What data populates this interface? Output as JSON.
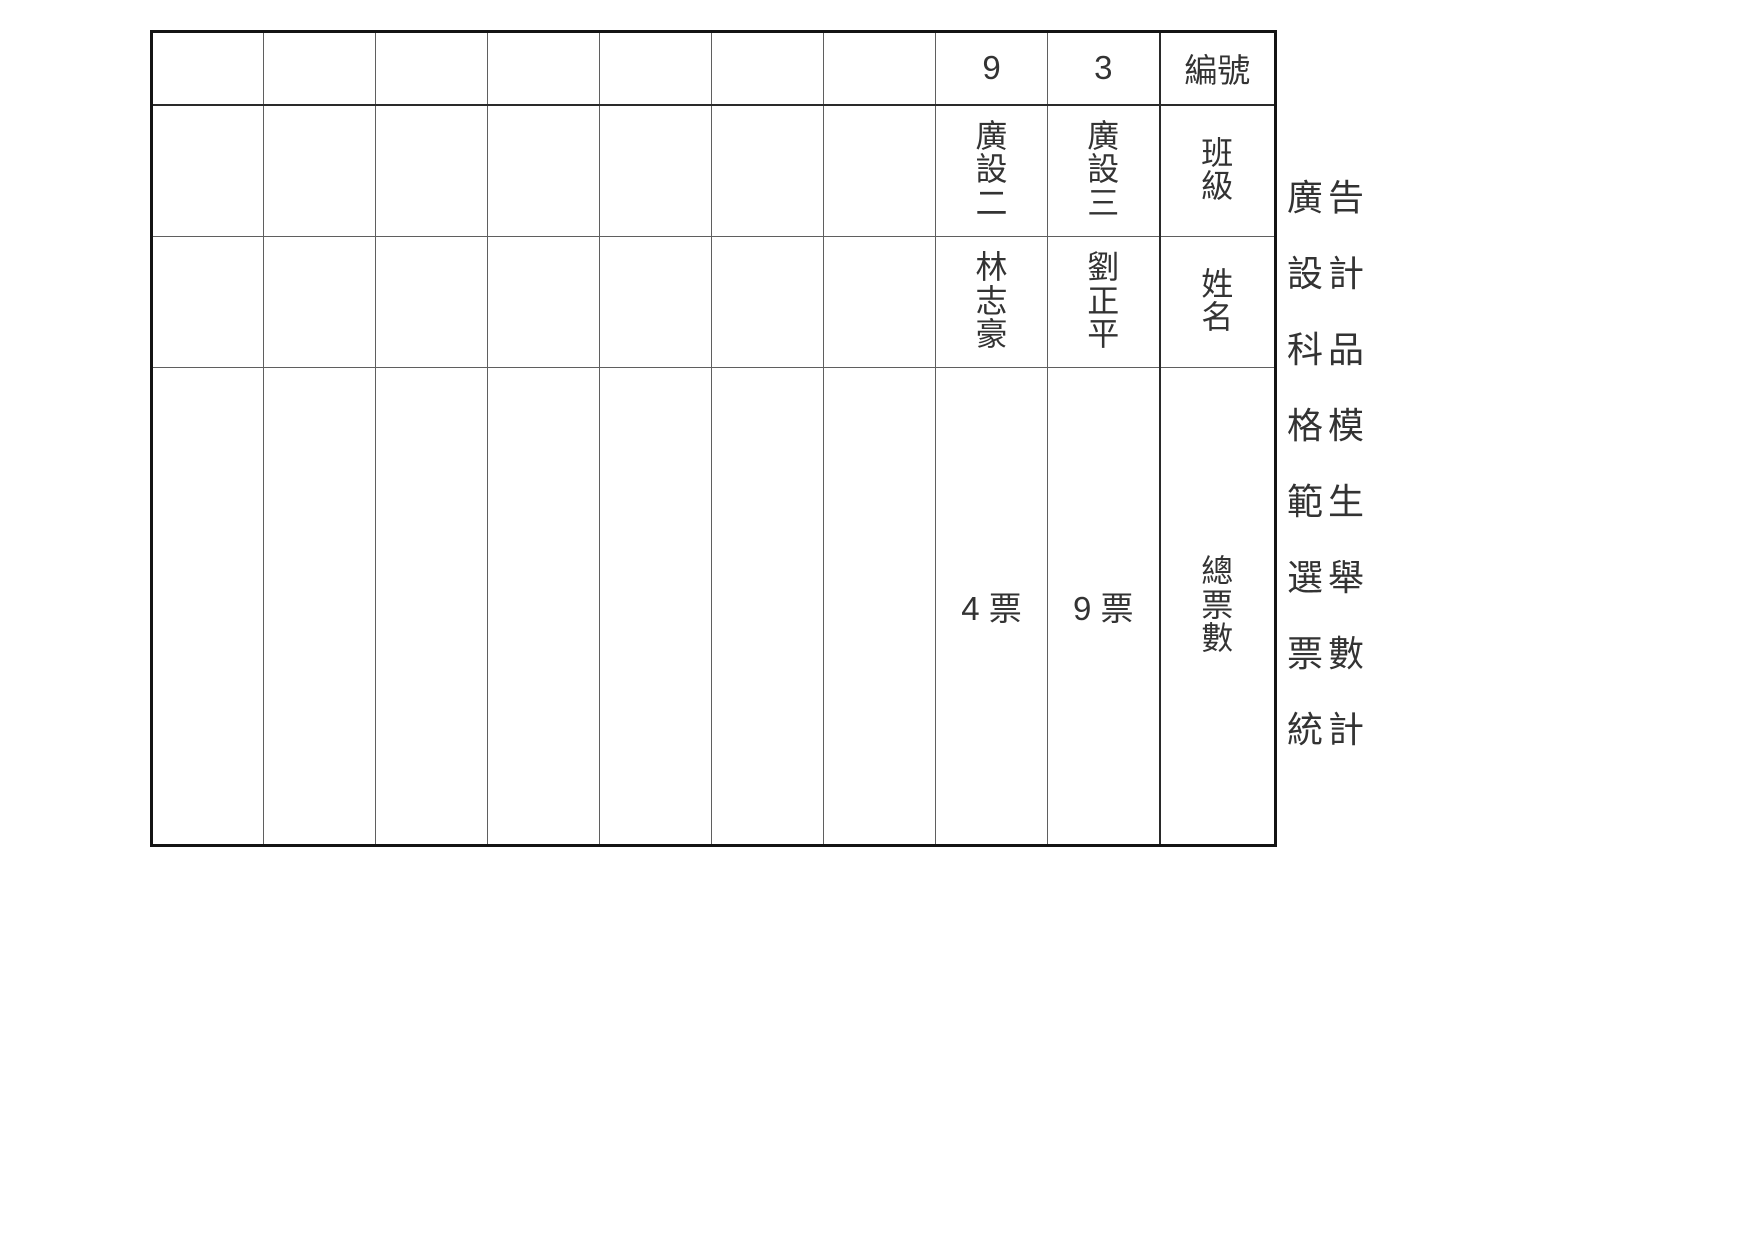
{
  "title": "廣告設計科品格模範生選舉票數統計",
  "table": {
    "headers": {
      "id": "編號",
      "class": "班級",
      "name": "姓名",
      "total_votes": "總票數"
    },
    "candidates": [
      {
        "id": "3",
        "class": "廣設三",
        "name": "劉正平",
        "votes": "9 票"
      },
      {
        "id": "9",
        "class": "廣設二",
        "name": "林志豪",
        "votes": "4 票"
      }
    ],
    "empty_data_columns": 7
  },
  "colors": {
    "background": "#ffffff",
    "text": "#333333",
    "grid_line": "#5f5f5f",
    "emphasis_line": "#2a2a2a",
    "outer_border": "#141414"
  }
}
